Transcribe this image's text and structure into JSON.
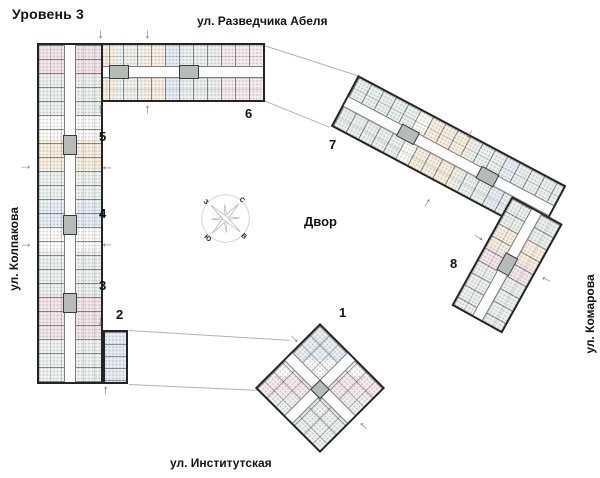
{
  "title": "Уровень 3",
  "streets": {
    "top": "ул. Разведчика Абеля",
    "bottom": "ул. Институтская",
    "left": "ул. Колпакова",
    "right": "ул. Комарова"
  },
  "courtyard": "Двор",
  "compass": {
    "north": "С",
    "east": "В",
    "south": "Ю",
    "west": "З"
  },
  "sections": {
    "s1": "1",
    "s2": "2",
    "s3": "3",
    "s4": "4",
    "s5": "5",
    "s6": "6",
    "s7": "7",
    "s8": "8"
  },
  "icons": {
    "entrance_arrow": "↓",
    "compass_rose": "compass-rose-icon"
  },
  "colors": {
    "wall": "#242424",
    "ink": "#141414",
    "tint_pink": "#e7cbd8",
    "tint_cream": "#f2dfc4",
    "tint_blue": "#cbdbee",
    "tint_green": "#d6e3dc",
    "core_gray": "#b7bbb7",
    "line_gray": "#b3b3b3",
    "arrow_gray": "#7a7a7a"
  }
}
